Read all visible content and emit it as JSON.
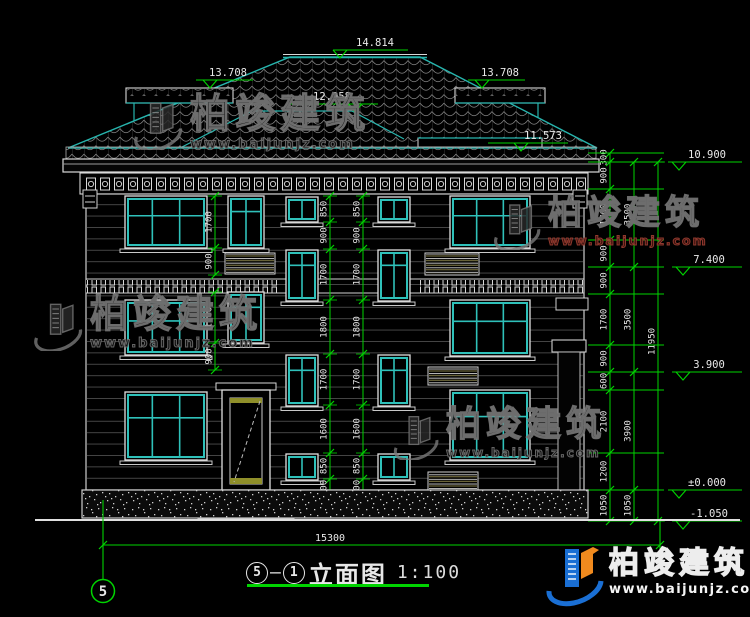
{
  "drawing_title": {
    "bubble_left": "5",
    "dash": "—",
    "bubble_right": "1",
    "name": "立面图",
    "scale": "1:100"
  },
  "grid_bubble": "5",
  "elevation_markers": {
    "ridge": "14.814",
    "upper_ledge_left": "13.708",
    "upper_ledge_right": "13.708",
    "lower_ridge": "12.958",
    "secondary_eave": "11.573",
    "main_eave": "10.900",
    "level3": "7.400",
    "level2": "3.900",
    "ground": "±0.000",
    "site": "-1.050"
  },
  "dimensions": {
    "right_inner": [
      "300",
      "900",
      "1700",
      "900",
      "900",
      "1700",
      "900",
      "600",
      "2100",
      "1200",
      "1050"
    ],
    "right_floors": [
      "3500",
      "3500",
      "3900",
      "1050"
    ],
    "right_total": [
      "11950"
    ],
    "center_left": [
      "850",
      "900",
      "1700",
      "1800",
      "1700",
      "1600",
      "850",
      "600"
    ],
    "center_right": [
      "850",
      "900",
      "1700",
      "1800",
      "1700",
      "1600",
      "850",
      "600"
    ],
    "facade_left_upper": [
      "1700",
      "900"
    ],
    "facade_left_lower": [
      "1700",
      "900"
    ],
    "bottom_width": "15300"
  },
  "watermark": {
    "brand": "柏竣建筑",
    "url": "www.baijunjz.com"
  },
  "colors": {
    "dim_green": "#00d400",
    "cad_teal": "#2fc1ba",
    "cad_white": "#e8e8e8",
    "logo_blue": "#1a6fd4",
    "logo_orange": "#f08a1e",
    "watermark_red": "#8b2c2c"
  }
}
